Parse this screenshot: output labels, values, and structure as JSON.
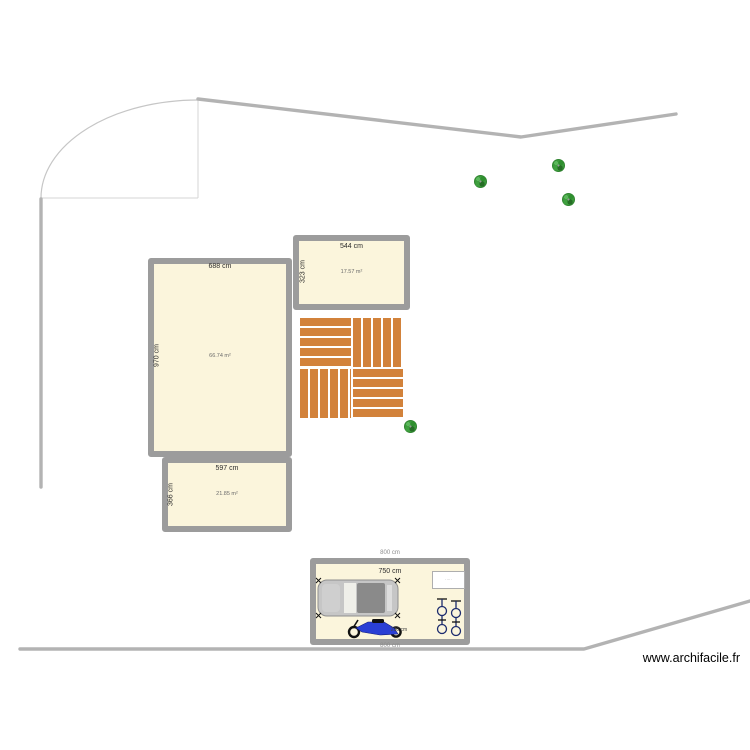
{
  "plan": {
    "watermark": "www.archifacile.fr"
  },
  "rooms": [
    {
      "label_width": "688 cm",
      "label_height": "970 cm",
      "label_area": "66.74 m²"
    },
    {
      "label_width": "544 cm",
      "label_height": "323 cm",
      "label_area": "17.57 m²"
    },
    {
      "label_width": "597 cm",
      "label_height": "366 cm",
      "label_area": "21.85 m²"
    }
  ],
  "garage": {
    "label_outer_top": "800 cm",
    "label_inner": "750 cm",
    "label_outer_bottom": "800 cm",
    "label_motorcycle": "230 cm",
    "label_box": "·····"
  }
}
